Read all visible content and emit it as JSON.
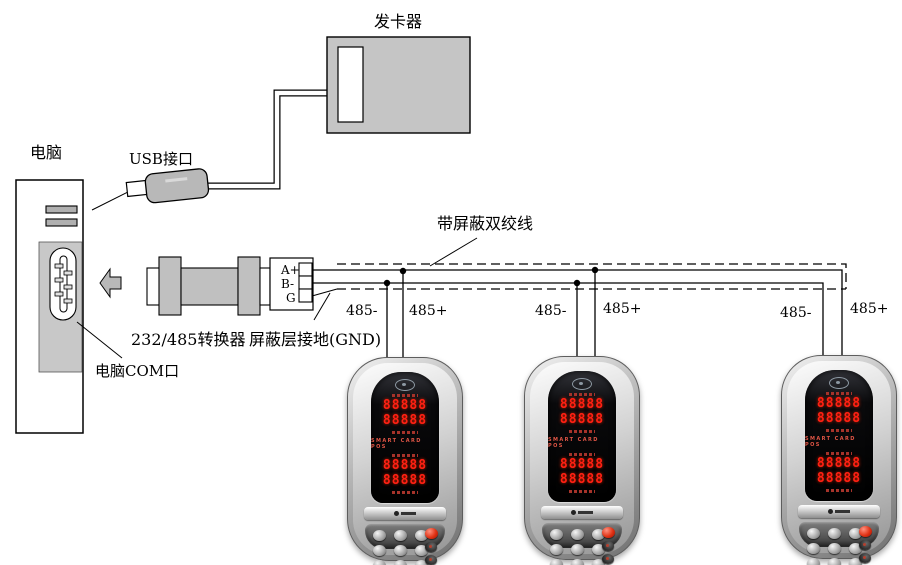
{
  "diagram": {
    "labels": {
      "card_issuer": "发卡器",
      "computer": "电脑",
      "usb_port": "USB接口",
      "converter": "232/485转换器",
      "shield_ground": "屏蔽层接地(GND)",
      "computer_com": "电脑COM口",
      "twisted_pair": "带屏蔽双绞线"
    },
    "terminal_block": {
      "pins": [
        "A+",
        "B-",
        "G"
      ]
    },
    "wire_labels": {
      "drop1_minus": "485-",
      "drop1_plus": "485+",
      "drop2_minus": "485-",
      "drop2_plus": "485+",
      "drop3_minus": "485-",
      "drop3_plus": "485+"
    },
    "colors": {
      "line": "#000000",
      "box_gray": "#c5c5c5",
      "background": "#ffffff",
      "led_red": "#ff2013",
      "keypad_dark": "#4a4a4a",
      "red_key": "#cc1400"
    }
  },
  "pos_device": {
    "brand_text": "SMART CARD POS",
    "display_rows": [
      "88888",
      "88888",
      "88888",
      "88888"
    ]
  }
}
